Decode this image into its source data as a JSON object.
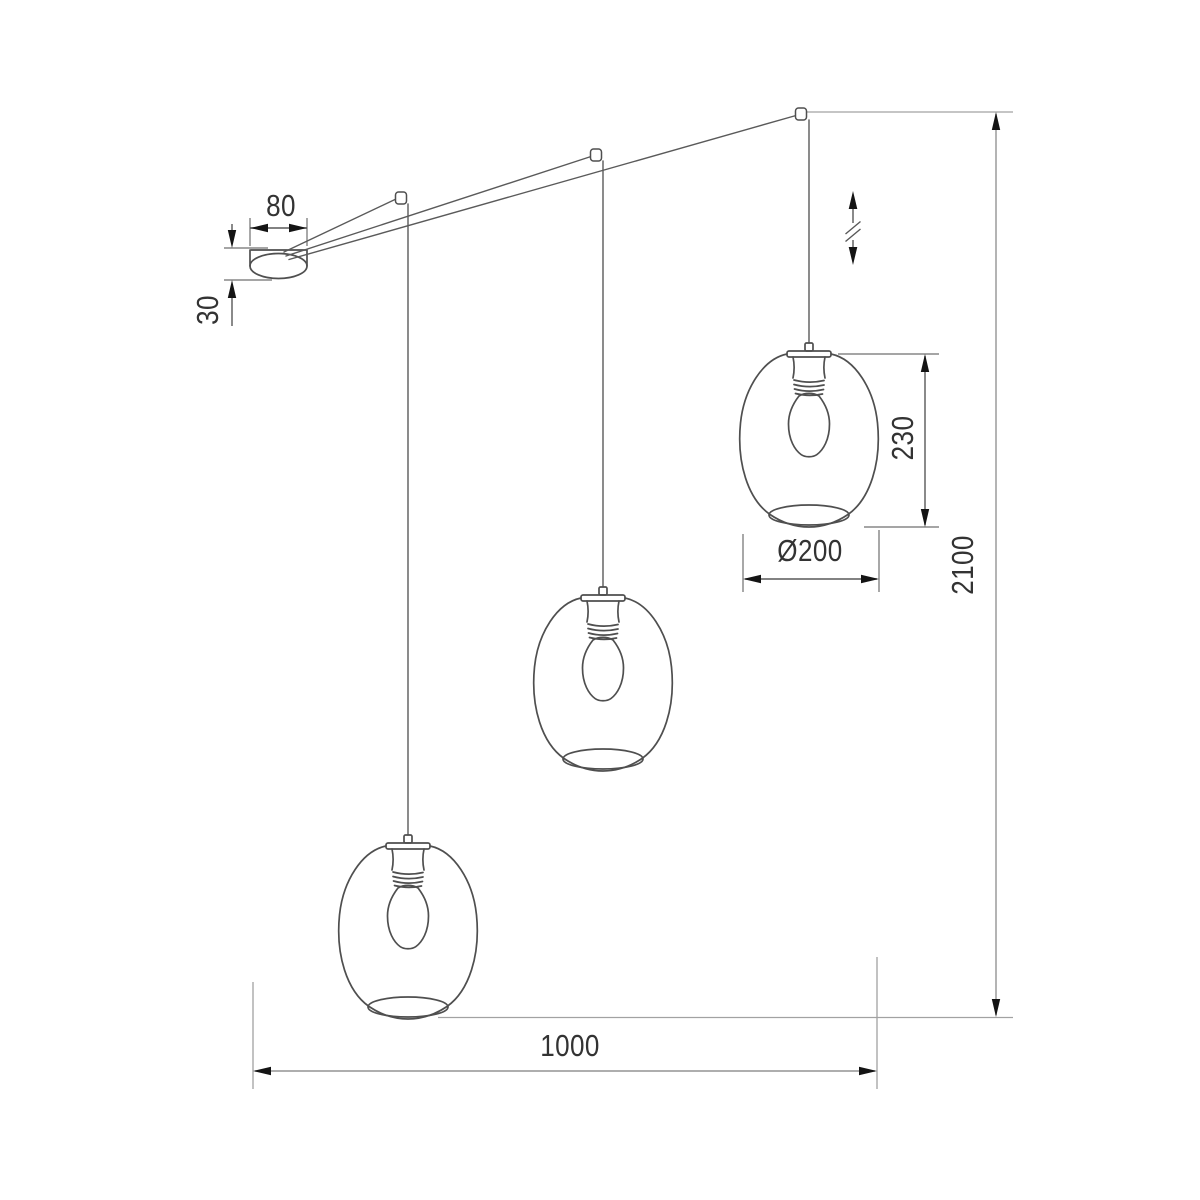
{
  "page": {
    "background_color": "#ffffff"
  },
  "drawing": {
    "kind": "technical dimension drawing",
    "subject": "three-shade cascading pendant ceiling lamp with canopy, cables and Edison bulbs",
    "colors": {
      "outline": "#4f4f4f",
      "dimension_lines": "#585858",
      "long_dimension_lines": "#949494",
      "arrows": "#141414",
      "text": "#333333"
    },
    "dimensions": [
      {
        "id": "canopy-width",
        "label": "80",
        "rotated": false
      },
      {
        "id": "canopy-height",
        "label": "30",
        "rotated": true
      },
      {
        "id": "shade-height",
        "label": "230",
        "rotated": true
      },
      {
        "id": "shade-diameter",
        "label": "Ø200",
        "rotated": false
      },
      {
        "id": "overall-height",
        "label": "2100",
        "rotated": true
      },
      {
        "id": "overall-width",
        "label": "1000",
        "rotated": false
      }
    ],
    "symbols": [
      {
        "id": "height-adjust-symbol",
        "glyph": "double vertical arrow with break marks"
      }
    ],
    "parts": {
      "canopy_count": 1,
      "hook_count": 3,
      "shade_count": 3
    }
  }
}
